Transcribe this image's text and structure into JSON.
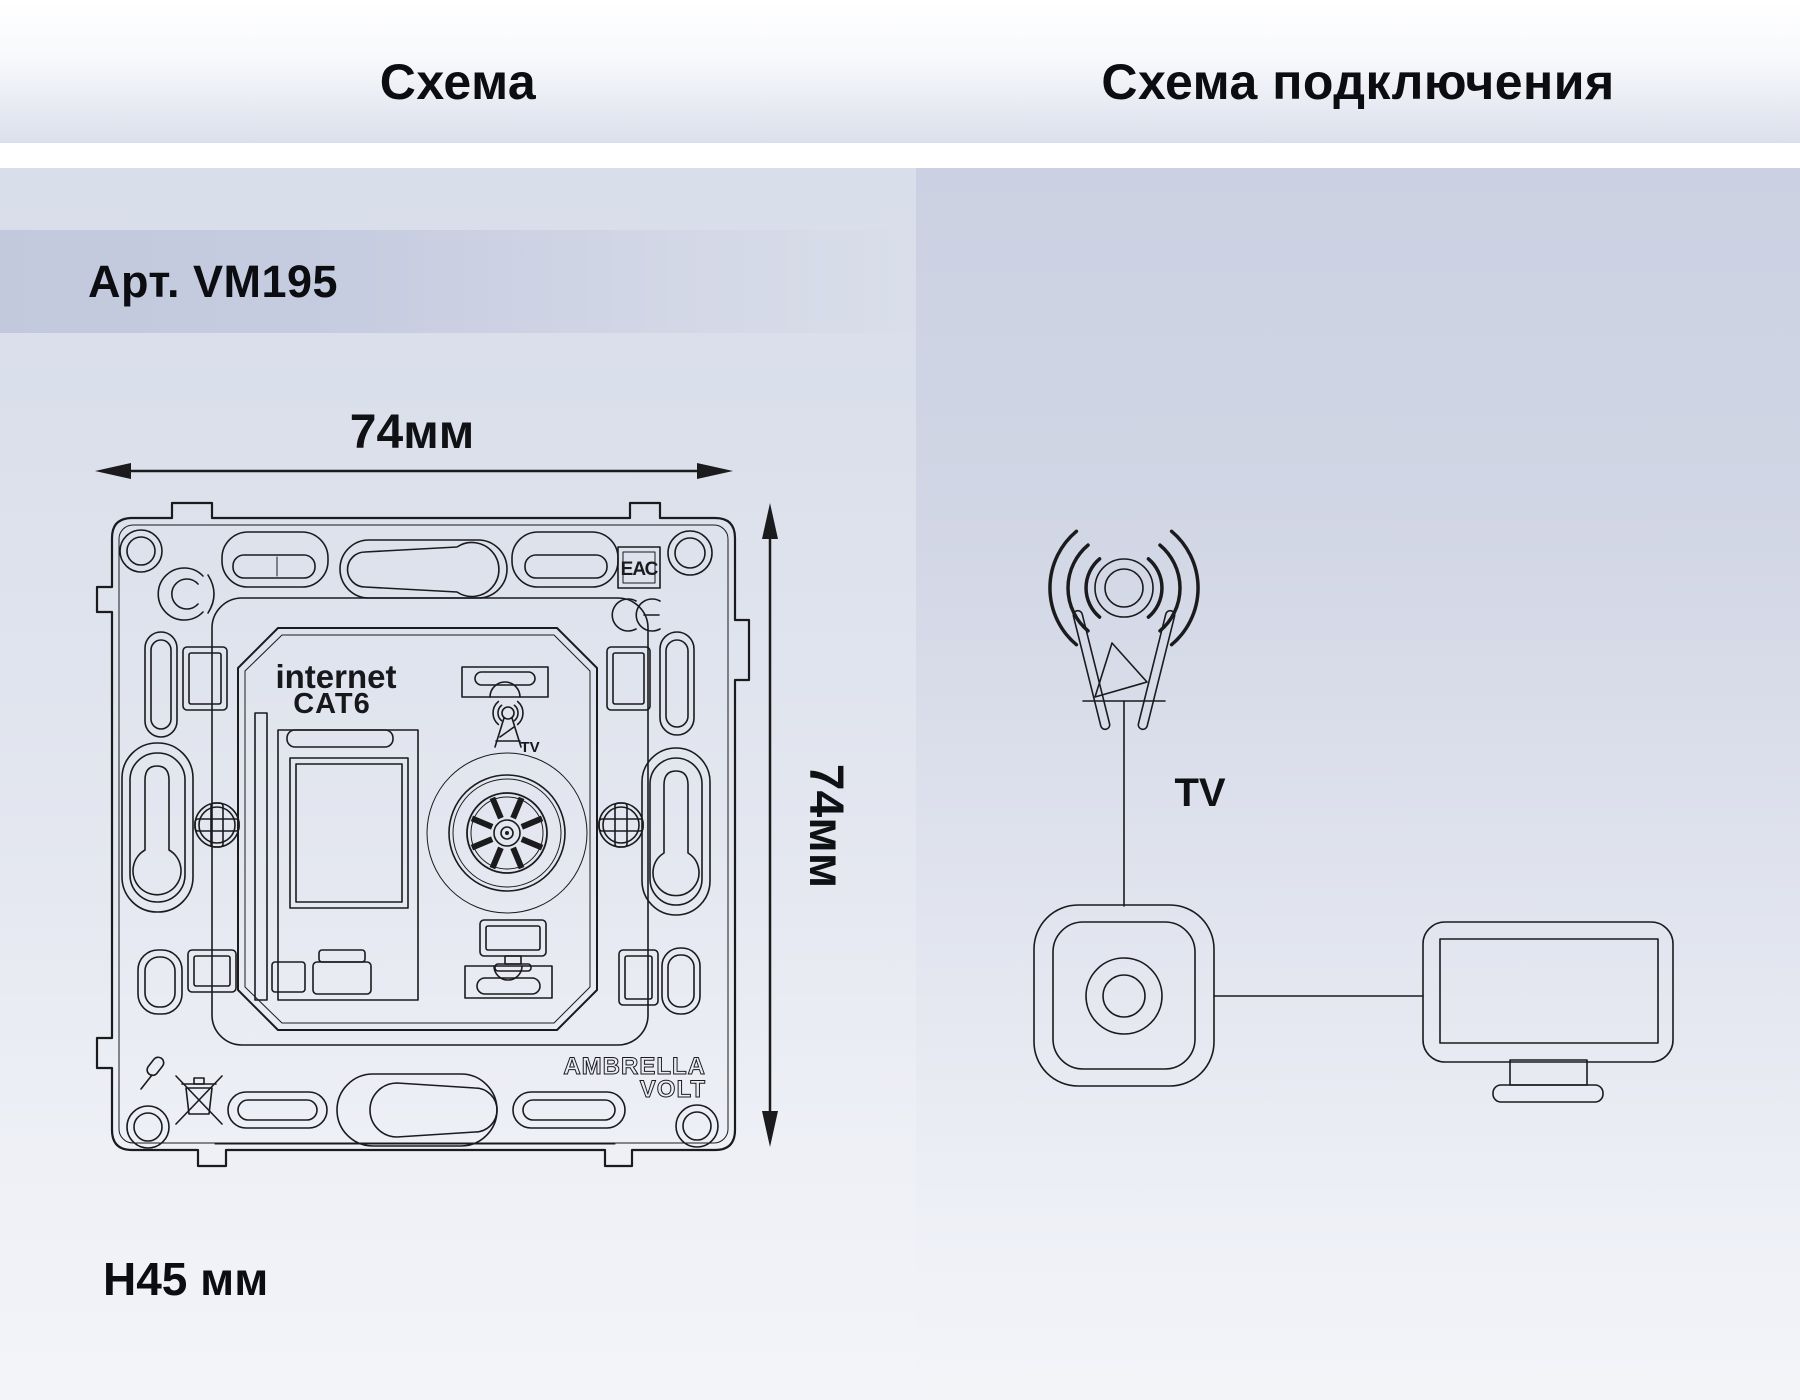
{
  "titles": {
    "left": "Схема",
    "right": "Схема подключения"
  },
  "article": "Арт. VM195",
  "dimensions": {
    "width_label": "74мм",
    "height_label": "74мм",
    "depth_label": "H45 мм"
  },
  "socket_drawing": {
    "port_label_line1": "internet",
    "port_label_line2": "CAT6",
    "tv_antenna_label": "TV",
    "eac_mark": "ЕАС",
    "ce_mark": "CE",
    "brand_line1": "AMBRELLA",
    "brand_line2": "VOLT"
  },
  "connection_diagram": {
    "signal_label": "TV"
  },
  "colors": {
    "line": "#1b1b1e",
    "text": "#0e0f12",
    "white_band": "#ffffff",
    "panel_left_top": "#d8deea",
    "panel_right_top": "#cbd1e2",
    "article_band": "#c2c9dd",
    "page_bottom": "#f3f4f9"
  }
}
